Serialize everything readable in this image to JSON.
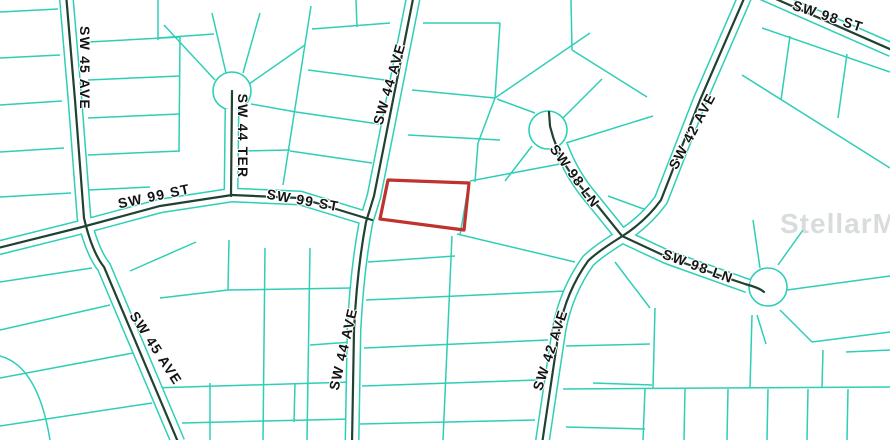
{
  "map": {
    "watermark": "StellarMLS",
    "colors": {
      "background": "#ffffff",
      "parcel_line": "#2ecfb5",
      "street_centerline": "#1f4233",
      "street_fill": "#ffffff",
      "highlight": "#bf332e",
      "label_text": "#141414",
      "watermark_gray": "#c2c7c7"
    },
    "street_labels": [
      {
        "id": "sw-45-ave-upper",
        "label": "SW 45 AVE"
      },
      {
        "id": "sw-44-ter",
        "label": "SW 44 TER"
      },
      {
        "id": "sw-99-st-west",
        "label": "SW 99 ST"
      },
      {
        "id": "sw-99-st-east",
        "label": "SW 99 ST"
      },
      {
        "id": "sw-44-ave-upper",
        "label": "SW 44 AVE"
      },
      {
        "id": "sw-44-ave-lower",
        "label": "SW 44 AVE"
      },
      {
        "id": "sw-42-ave-upper",
        "label": "SW 42 AVE"
      },
      {
        "id": "sw-42-ave-lower",
        "label": "SW 42 AVE"
      },
      {
        "id": "sw-98-st",
        "label": "SW 98 ST"
      },
      {
        "id": "sw-98-ln-upper",
        "label": "SW 98 LN"
      },
      {
        "id": "sw-98-ln-lower",
        "label": "SW 98 LN"
      },
      {
        "id": "sw-45-ave-lower",
        "label": "SW 45 AVE"
      }
    ]
  }
}
